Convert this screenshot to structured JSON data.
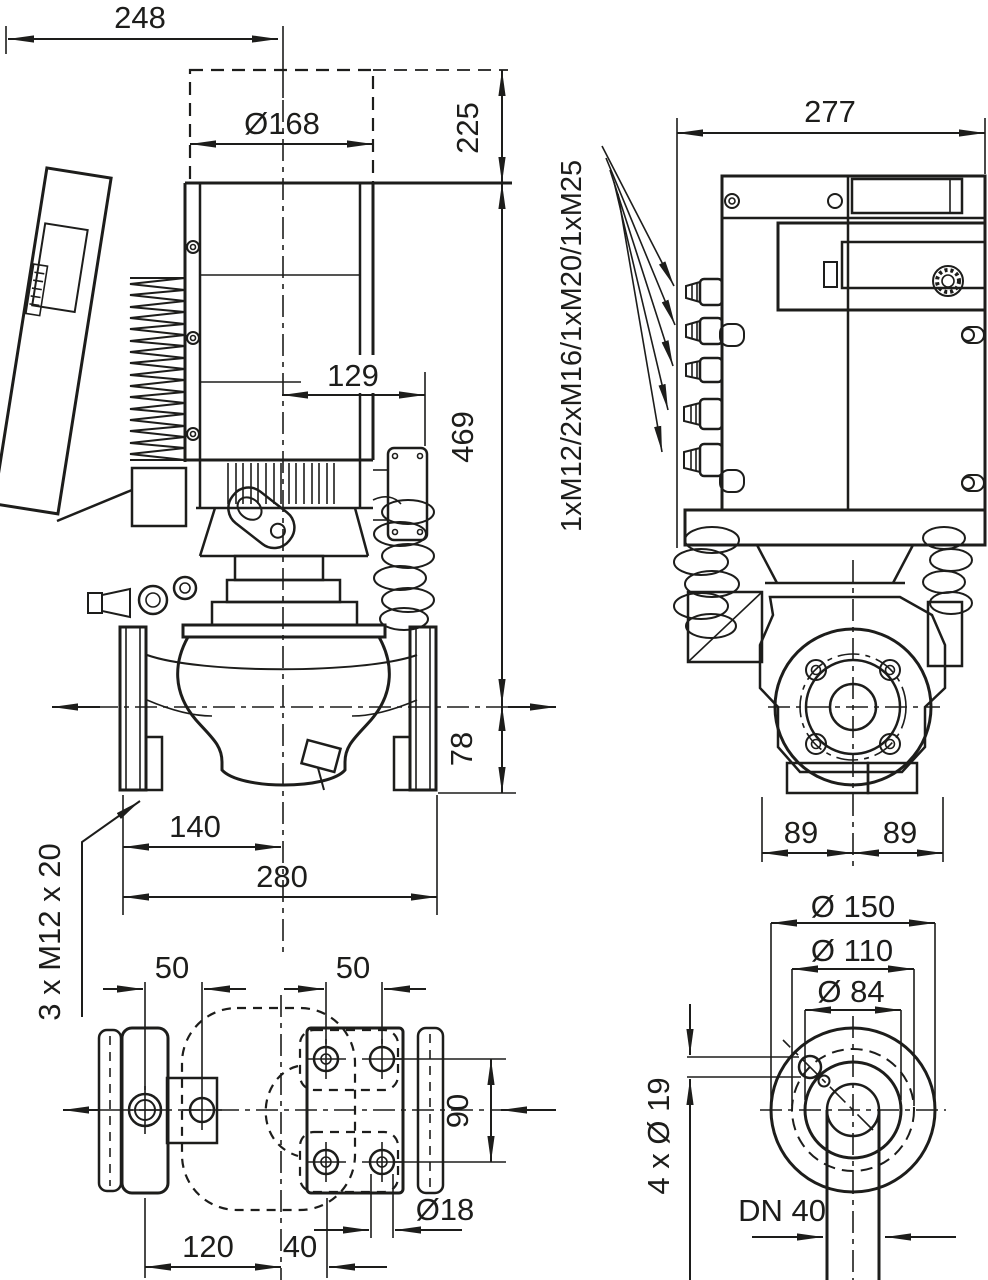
{
  "drawing": {
    "background": "#ffffff",
    "line_color": "#1d1d1b",
    "views": {
      "side": {
        "width_total": "248",
        "motor_diameter": "Ø168",
        "height_upper": "225",
        "height_axis": "469",
        "module_depth": "129",
        "axis_to_flange": "78",
        "foot_to_axis": "140",
        "flange_to_flange": "280",
        "foot_thread": "3 x M12 x 20"
      },
      "front": {
        "width_total": "277",
        "cable_glands": "1xM12/2xM16/1xM20/1xM25",
        "axis_left": "89",
        "axis_right": "89"
      },
      "base": {
        "pitch_left": "50",
        "pitch_right": "50",
        "pitch_depth": "90",
        "hole_diameter": "Ø18",
        "left_to_center": "120",
        "center_to_hole": "40"
      },
      "flange": {
        "outer_diameter": "Ø 150",
        "bolt_circle": "Ø 110",
        "hub_diameter": "Ø 84",
        "bolt_holes": "4 x Ø 19",
        "nominal_bore": "DN 40"
      }
    }
  }
}
